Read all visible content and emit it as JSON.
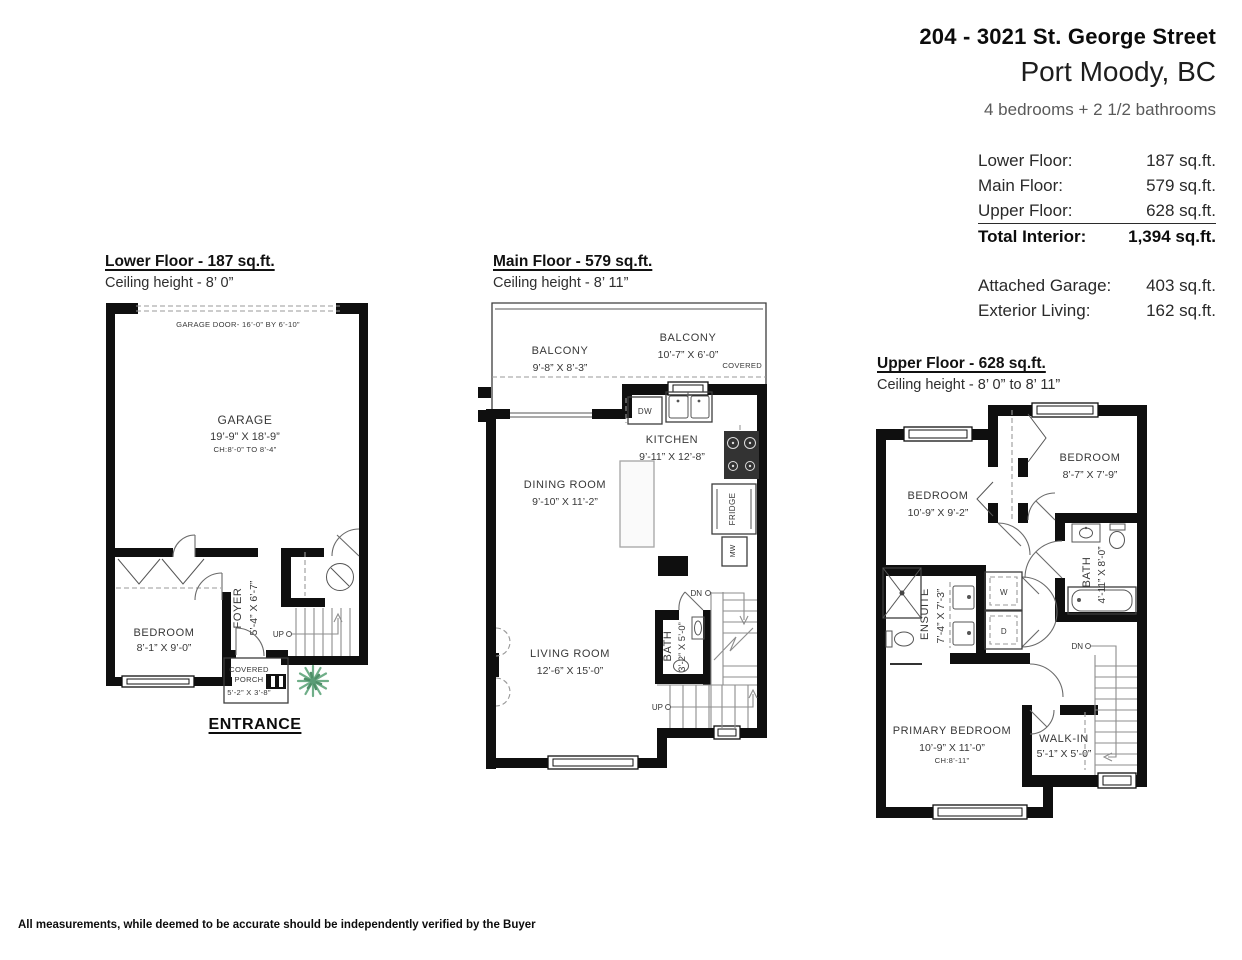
{
  "header": {
    "address": "204 - 3021 St. George Street",
    "city": "Port Moody, BC",
    "bedrooms": "4 bedrooms + 2 1/2 bathrooms"
  },
  "areas": {
    "rows": [
      {
        "label": "Lower Floor:",
        "value": "187 sq.ft."
      },
      {
        "label": "Main Floor:",
        "value": "579 sq.ft."
      },
      {
        "label": "Upper Floor:",
        "value": "628 sq.ft."
      }
    ],
    "total": {
      "label": "Total Interior:",
      "value": "1,394 sq.ft."
    },
    "extras": [
      {
        "label": "Attached Garage:",
        "value": "403 sq.ft."
      },
      {
        "label": "Exterior Living:",
        "value": "162 sq.ft."
      }
    ]
  },
  "lower": {
    "title": "Lower Floor - 187 sq.ft.",
    "ceiling": "Ceiling height - 8’ 0”",
    "garage_door": "GARAGE DOOR- 16’-0” BY 6’-10”",
    "garage": {
      "name": "GARAGE",
      "dims": "19’-9” X 18’-9”",
      "ch": "CH:8’-0” TO 8’-4”"
    },
    "bedroom": {
      "name": "BEDROOM",
      "dims": "8’-1” X 9’-0”"
    },
    "foyer": {
      "name": "FOYER",
      "dims": "5’-4” X 6’-7”"
    },
    "porch": {
      "line1": "COVERED",
      "line2": "PORCH",
      "dims": "5’-2” X 3’-8”"
    },
    "up": "UP",
    "entrance": "ENTRANCE"
  },
  "main": {
    "title": "Main Floor - 579 sq.ft.",
    "ceiling": "Ceiling height - 8’ 11”",
    "balcony_left": {
      "name": "BALCONY",
      "dims": "9’-8” X 8’-3”"
    },
    "balcony_right": {
      "name": "BALCONY",
      "dims": "10’-7” X 6’-0”",
      "covered": "COVERED"
    },
    "kitchen": {
      "name": "KITCHEN",
      "dims": "9’-11” X 12’-8”"
    },
    "dining": {
      "name": "DINING ROOM",
      "dims": "9’-10” X 11’-2”"
    },
    "living": {
      "name": "LIVING ROOM",
      "dims": "12’-6” X 15’-0”"
    },
    "bath": {
      "name": "BATH",
      "dims": "3’-2” X 5’-0”"
    },
    "dw": "DW",
    "fridge": "FRIDGE",
    "mw": "MW",
    "dn": "DN",
    "up": "UP"
  },
  "upper": {
    "title": "Upper Floor - 628 sq.ft.",
    "ceiling": "Ceiling height - 8’ 0” to 8’ 11”",
    "bedroom_right": {
      "name": "BEDROOM",
      "dims": "8’-7” X 7’-9”"
    },
    "bedroom_left": {
      "name": "BEDROOM",
      "dims": "10’-9” X 9’-2”"
    },
    "ensuite": {
      "name": "ENSUITE",
      "dims": "7’-4” X 7’-3”"
    },
    "bath": {
      "name": "BATH",
      "dims": "4’-11” X 8’-0”"
    },
    "washer": "W",
    "dryer": "D",
    "primary": {
      "name": "PRIMARY BEDROOM",
      "dims": "10’-9” X 11’-0”",
      "ch": "CH:8’-11”"
    },
    "walkin": {
      "name": "WALK-IN",
      "dims": "5’-1” X 5’-0”"
    },
    "dn": "DN"
  },
  "footer": {
    "disclaimer": "All measurements, while deemed to be accurate should be independently verified by the Buyer"
  },
  "colors": {
    "wall": "#0f0f0f",
    "plant_light": "#6fae88",
    "plant_dark": "#4e8f68"
  }
}
